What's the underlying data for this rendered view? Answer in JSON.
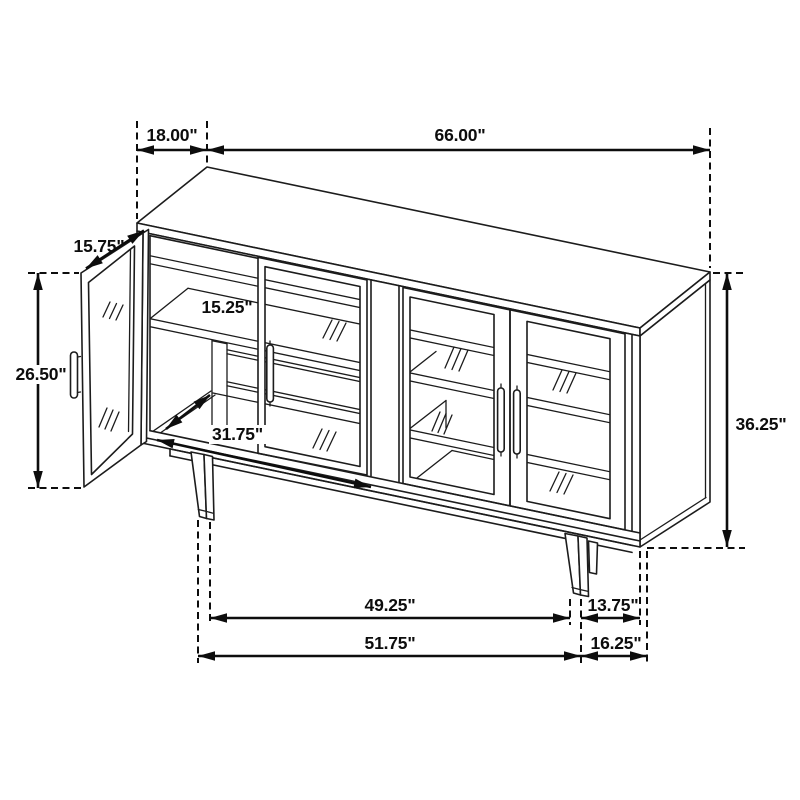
{
  "diagram": {
    "colors": {
      "background": "#ffffff",
      "line": "#1c1c1c",
      "dimension": "#0d0d0d"
    },
    "dims": {
      "top_depth": "18.00\"",
      "top_width": "66.00\"",
      "door_width": "15.75\"",
      "shelf_depth": "15.25\"",
      "door_height": "26.50\"",
      "interior_width": "31.75\"",
      "overall_height": "36.25\"",
      "front_leg_span": "49.25\"",
      "right_leg_inset": "13.75\"",
      "outer_leg_span": "51.75\"",
      "side_leg_inset": "16.25\""
    }
  }
}
